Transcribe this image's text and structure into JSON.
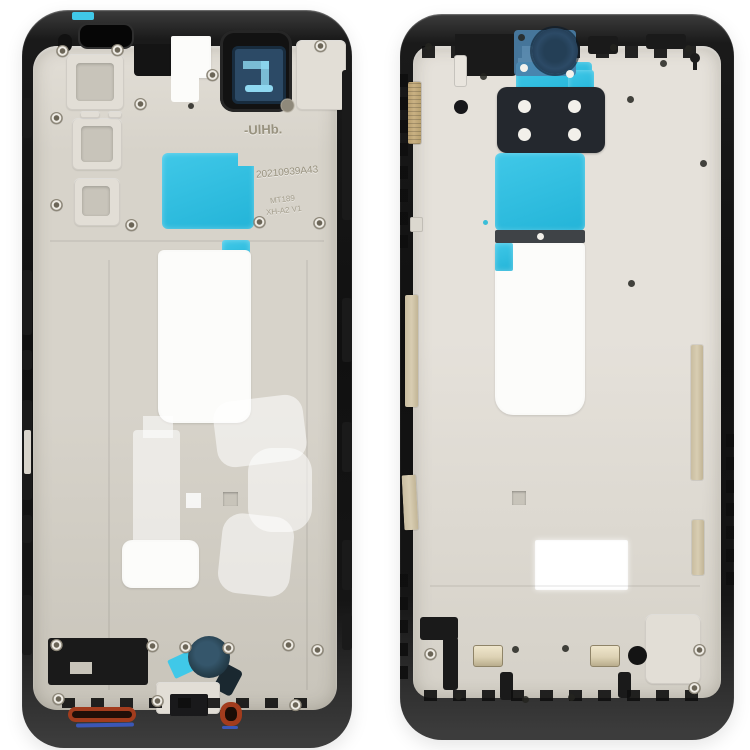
{
  "product_photo": {
    "subject": "two smartphone middle frame bezel plates",
    "left_bezel_markings": {
      "mark": "-UlHb.",
      "serial": "20210939A43",
      "model": "MT189",
      "revision": "XH-A2 V1"
    }
  },
  "colors": {
    "background": "#ffffff",
    "frame-black": "#1a1a1a",
    "frame-black-edge": "#3c3c3c",
    "plate": "#d7d3ca",
    "plate-dark": "#c8c4ba",
    "plate-light": "#e2ded6",
    "plate-right": "#e5e1da",
    "plate-right-dark": "#d5d1c8",
    "sticker-white": "#fcfcfa",
    "tape-cyan": "#40c8e8",
    "tape-cyan-deep": "#23b4d8",
    "tape-blue-muted": "#4a80a8",
    "camera-navy": "#2c4a66",
    "camera-navy-dark": "#182c3e",
    "camera-blue-light": "#8fd8f0",
    "sticker-black": "#24282e",
    "gold": "#c9b183",
    "tan": "#d8cdb2",
    "brass": "#ddd2b4",
    "red-gasket": "#a23c1d",
    "blue-seal": "#3b57b6",
    "teal-mic": "#27414f",
    "etch": "#98927f",
    "screw-face": "#eeebe4",
    "screw-ring": "#8d8779",
    "hole-dark": "#242420"
  }
}
